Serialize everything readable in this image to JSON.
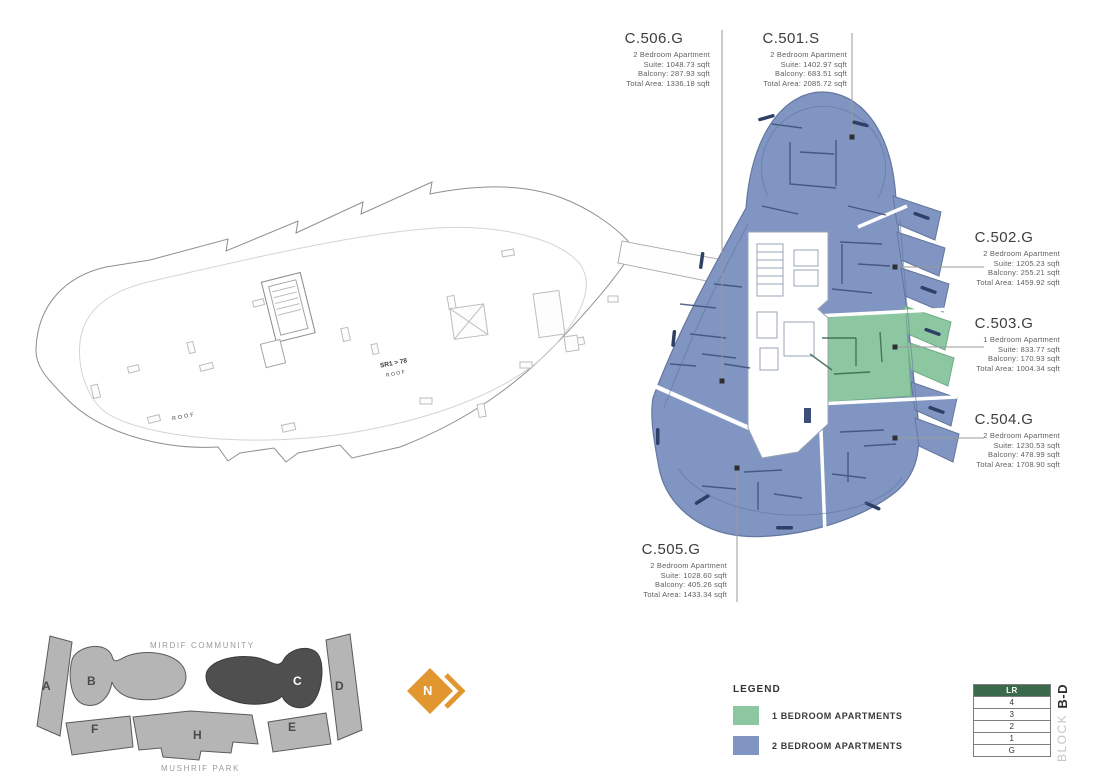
{
  "units": [
    {
      "id": "C.506.G",
      "type": "2 Bedroom Apartment",
      "suite": "Suite: 1048.73 sqft",
      "balcony": "Balcony: 287.93 sqft",
      "total": "Total Area: 1336.18 sqft"
    },
    {
      "id": "C.501.S",
      "type": "2 Bedroom Apartment",
      "suite": "Suite: 1402.97 sqft",
      "balcony": "Balcony: 683.51 sqft",
      "total": "Total Area: 2085.72 sqft"
    },
    {
      "id": "C.502.G",
      "type": "2 Bedroom Apartment",
      "suite": "Suite: 1205.23 sqft",
      "balcony": "Balcony: 255.21 sqft",
      "total": "Total Area: 1459.92 sqft"
    },
    {
      "id": "C.503.G",
      "type": "1 Bedroom Apartment",
      "suite": "Suite: 833.77 sqft",
      "balcony": "Balcony: 170.93 sqft",
      "total": "Total Area: 1004.34 sqft"
    },
    {
      "id": "C.504.G",
      "type": "2 Bedroom Apartment",
      "suite": "Suite: 1230.53 sqft",
      "balcony": "Balcony: 478.99 sqft",
      "total": "Total Area: 1708.90 sqft"
    },
    {
      "id": "C.505.G",
      "type": "2 Bedroom Apartment",
      "suite": "Suite: 1028.60 sqft",
      "balcony": "Balcony: 405.26 sqft",
      "total": "Total Area: 1433.34 sqft"
    }
  ],
  "legend": {
    "title": "LEGEND",
    "items": [
      {
        "label": "1 BEDROOM APARTMENTS",
        "color": "#8dc7a1"
      },
      {
        "label": "2 BEDROOM APARTMENTS",
        "color": "#8095c1"
      }
    ]
  },
  "floor_selector": {
    "rows": [
      "LR",
      "4",
      "3",
      "2",
      "1",
      "G"
    ],
    "active": "LR",
    "active_color": "#3b694c",
    "block_label_light": "BLOCK",
    "block_label_bold": "B-D"
  },
  "site_map": {
    "top_label": "MIRDIF COMMUNITY",
    "bottom_label": "MUSHRIF PARK",
    "blocks": [
      {
        "label": "A",
        "state": "normal"
      },
      {
        "label": "B",
        "state": "normal"
      },
      {
        "label": "C",
        "state": "selected"
      },
      {
        "label": "D",
        "state": "normal"
      },
      {
        "label": "E",
        "state": "normal"
      },
      {
        "label": "F",
        "state": "normal"
      },
      {
        "label": "H",
        "state": "normal"
      }
    ]
  },
  "north": {
    "label": "N"
  },
  "roof": {
    "sr_tag": "SR1 > 78",
    "roof_label_1": "ROOF",
    "roof_label_2": "ROOF"
  },
  "colors": {
    "one_bed": "#8dc7a1",
    "two_bed": "#8095c1",
    "selected_site_block": "#4f4f4f",
    "site_block": "#b5b5b5",
    "north": "#e2962f",
    "table_header": "#3b694c"
  }
}
